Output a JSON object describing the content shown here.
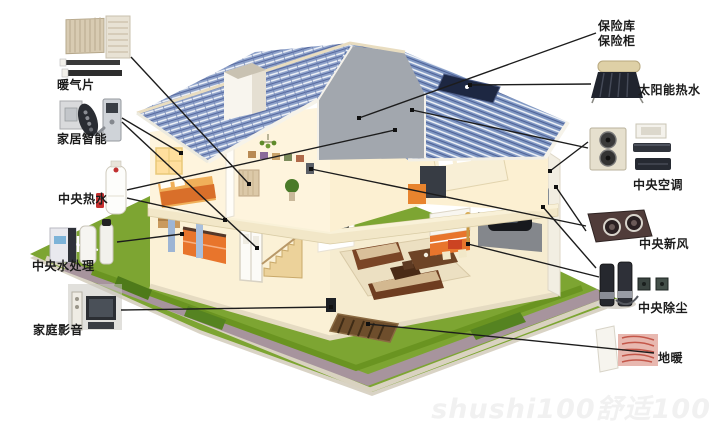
{
  "watermark": {
    "text": "shushi100舒适100"
  },
  "colors": {
    "roof_blue": "#8fa3cb",
    "roof_line": "#51639a",
    "lawn_green": "#7da532",
    "path_gray": "#a7949d",
    "accent_orange": "#e8752c",
    "callout_line": "#1c1c1c",
    "label_text": "#1b1b1b",
    "hot_water_badge_red": "#c62f2f"
  },
  "products": [
    {
      "icon": "radiator-thumbnail"
    },
    {
      "icon": "smart-home-devices-thumbnail"
    },
    {
      "icon": "water-heater-tank-thumbnail"
    },
    {
      "icon": "water-treatment-units-thumbnail"
    },
    {
      "icon": "av-speaker-tv-thumbnail"
    },
    {
      "icon": "solar-water-heater-thumbnail"
    },
    {
      "icon": "ac-units-thumbnail"
    },
    {
      "icon": "fresh-air-unit-thumbnail"
    },
    {
      "icon": "vacuum-units-thumbnail"
    },
    {
      "icon": "floor-heating-sample-thumbnail"
    }
  ],
  "callouts": [
    {
      "id": "radiator",
      "label": [
        "暖气片"
      ],
      "label_x": 57,
      "label_y": 78,
      "lines": [
        [
          131,
          57,
          249,
          184
        ]
      ]
    },
    {
      "id": "smart-home",
      "label": [
        "家居智能"
      ],
      "label_x": 57,
      "label_y": 132,
      "lines": [
        [
          122,
          118,
          181,
          153
        ],
        [
          122,
          122,
          257,
          248
        ]
      ]
    },
    {
      "id": "central-hot-water",
      "label": [
        "中央热水"
      ],
      "label_x": 58,
      "label_y": 192,
      "lines": [
        [
          127,
          190,
          395,
          130
        ],
        [
          127,
          198,
          225,
          220
        ]
      ]
    },
    {
      "id": "central-water-treatment",
      "label": [
        "中央水处理"
      ],
      "label_x": 32,
      "label_y": 259,
      "lines": [
        [
          117,
          242,
          182,
          234
        ]
      ]
    },
    {
      "id": "home-av",
      "label": [
        "家庭影音"
      ],
      "label_x": 33,
      "label_y": 323,
      "lines": [
        [
          121,
          310,
          331,
          307
        ]
      ]
    },
    {
      "id": "safe",
      "label": [
        "保险库",
        "保险柜"
      ],
      "label_x": 598,
      "label_y": 19,
      "lines": [
        [
          596,
          33,
          359,
          118
        ]
      ]
    },
    {
      "id": "solar-hot-water",
      "label": [
        "太阳能热水"
      ],
      "label_x": 638,
      "label_y": 83,
      "lines": [
        [
          591,
          84,
          470,
          85
        ]
      ]
    },
    {
      "id": "central-ac",
      "label": [
        "中央空调"
      ],
      "label_x": 633,
      "label_y": 178,
      "lines": [
        [
          588,
          142,
          550,
          171
        ],
        [
          588,
          148,
          412,
          110
        ]
      ]
    },
    {
      "id": "central-fresh-air",
      "label": [
        "中央新风"
      ],
      "label_x": 639,
      "label_y": 237,
      "lines": [
        [
          586,
          226,
          311,
          169
        ],
        [
          586,
          231,
          556,
          187
        ]
      ]
    },
    {
      "id": "central-vacuum",
      "label": [
        "中央除尘"
      ],
      "label_x": 638,
      "label_y": 301,
      "lines": [
        [
          596,
          268,
          543,
          207
        ],
        [
          599,
          277,
          468,
          244
        ]
      ]
    },
    {
      "id": "floor-heating",
      "label": [
        "地暖"
      ],
      "label_x": 658,
      "label_y": 351,
      "lines": [
        [
          654,
          353,
          368,
          324
        ]
      ]
    }
  ]
}
